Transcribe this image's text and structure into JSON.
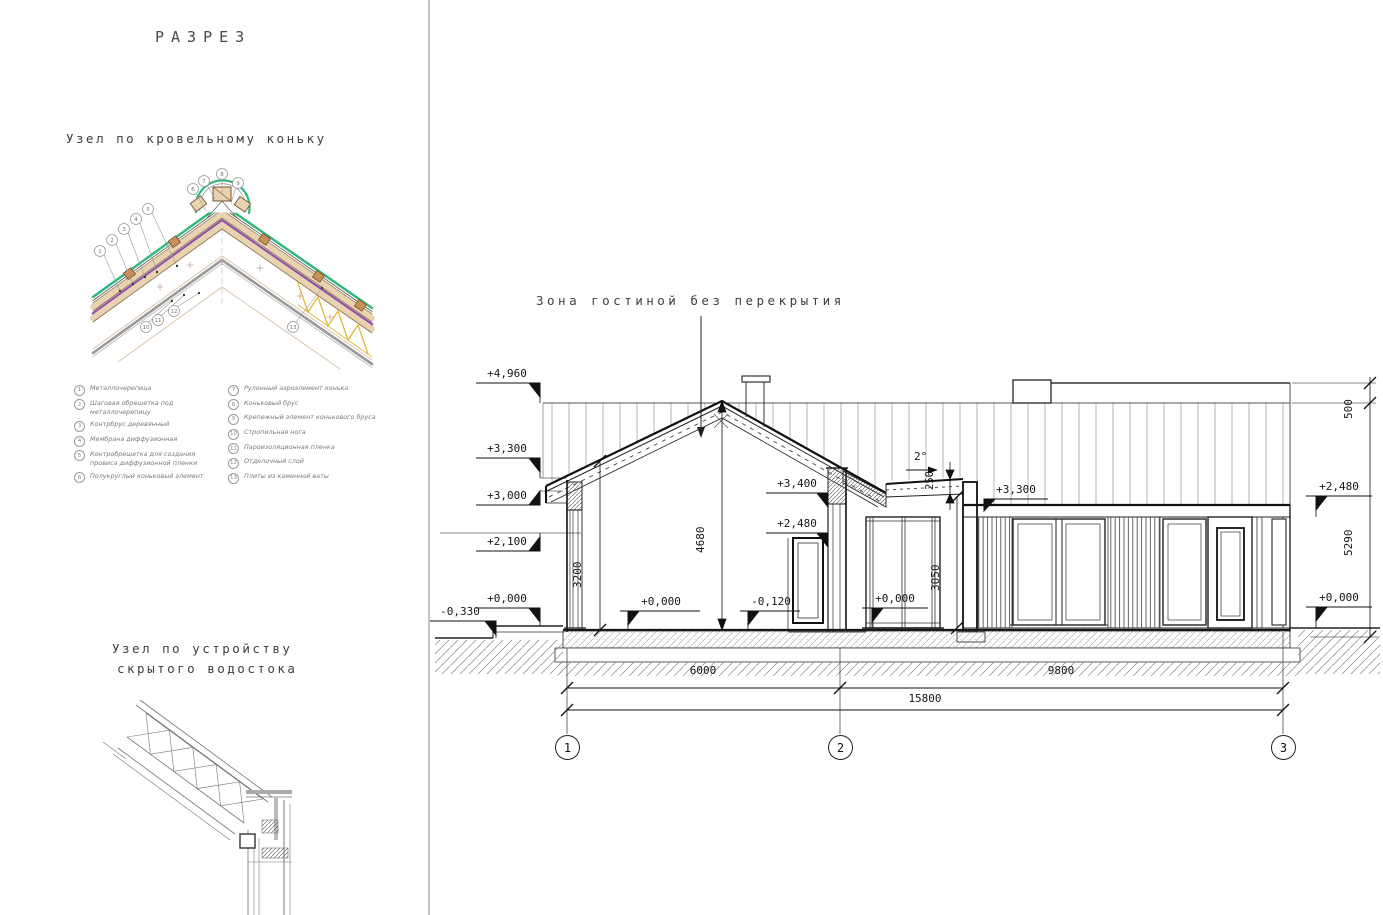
{
  "left_panel": {
    "title": "РАЗРЕЗ",
    "ridge_detail_title": "Узел по кровельному коньку",
    "drain_detail_title_line1": "Узел по устройству",
    "drain_detail_title_line2": "скрытого водостока",
    "legend_left": [
      {
        "num": "1",
        "text": "Металлочерепица"
      },
      {
        "num": "2",
        "text": "Шаговая обрешетка под металлочерепицу"
      },
      {
        "num": "3",
        "text": "Контрбрус деревянный"
      },
      {
        "num": "4",
        "text": "Мембрана диффузионная"
      },
      {
        "num": "5",
        "text": "Контробрешетка для создания провиса диффузионной пленки"
      },
      {
        "num": "6",
        "text": "Полукруглый коньковый элемент"
      }
    ],
    "legend_right": [
      {
        "num": "7",
        "text": "Рулонный аэроэлемент конька"
      },
      {
        "num": "8",
        "text": "Коньковый брус"
      },
      {
        "num": "9",
        "text": "Крепежный элемент конькового бруса"
      },
      {
        "num": "10",
        "text": "Стропильная нога"
      },
      {
        "num": "11",
        "text": "Пароизоляционная пленка"
      },
      {
        "num": "12",
        "text": "Отделочный слой"
      },
      {
        "num": "13",
        "text": "Плиты из каменной ваты"
      }
    ]
  },
  "section": {
    "zone_label": "Зона гостиной без перекрытия",
    "slope_label": "2°",
    "elevations": {
      "e4960": "+4,960",
      "e3300l": "+3,300",
      "e3000": "+3,000",
      "e2100": "+2,100",
      "e0l": "+0,000",
      "em330": "-0,330",
      "e0c": "+0,000",
      "em120": "-0,120",
      "e3400": "+3,400",
      "e2480c": "+2,480",
      "e0p": "+0,000",
      "e3300r": "+3,300",
      "e2480r": "+2,480",
      "e0r": "+0,000"
    },
    "dims": {
      "d3200": "3200",
      "d4680": "4680",
      "d3050": "3050",
      "d250": "250",
      "d500": "500",
      "d5290": "5290",
      "d6000": "6000",
      "d9800": "9800",
      "d15800": "15800"
    },
    "axes": [
      "1",
      "2",
      "3"
    ]
  },
  "ridge_callouts": [
    "1",
    "2",
    "3",
    "4",
    "5",
    "6",
    "7",
    "8",
    "9",
    "10",
    "11",
    "12",
    "13"
  ],
  "colors": {
    "roof_green": "#2db87a",
    "membrane_purple": "#8c4fa8",
    "wood_tan": "#e7d3b0",
    "insulation_yellow": "#e0b93c"
  }
}
